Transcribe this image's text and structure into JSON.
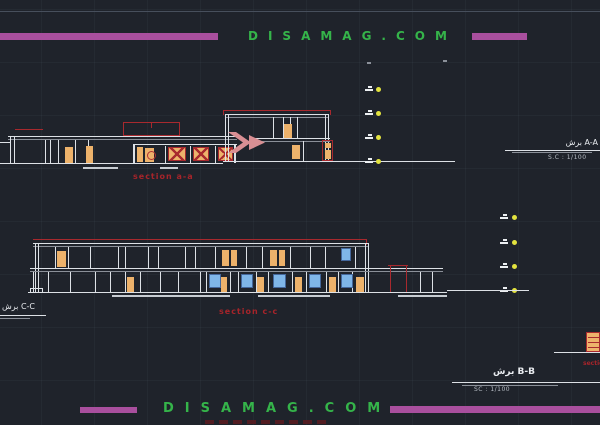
{
  "watermark": {
    "top": "DISAMAG.COM",
    "bottom": "DISAMAG.COM"
  },
  "sections": {
    "aa": {
      "label": "section a-a"
    },
    "cc": {
      "label": "section c-c"
    },
    "bb_fragment": "section b-b"
  },
  "titles": {
    "aa": {
      "name": "برش A-A",
      "scale": "S.C : 1/100"
    },
    "bb": {
      "name": "برش B-B",
      "scale": "SC : 1/100"
    },
    "cc": {
      "name": "برش C-C"
    }
  },
  "colors": {
    "background": "#1f232b",
    "accent_magenta": "#a94f9e",
    "brand_green": "#35b44a",
    "line_white": "#dde1e6",
    "cad_red": "#a8292e",
    "fill_orange": "#edb26b",
    "fill_blue": "#7fb6e8",
    "marker_yellow": "#e3e33f",
    "label_red": "#a6242a"
  }
}
